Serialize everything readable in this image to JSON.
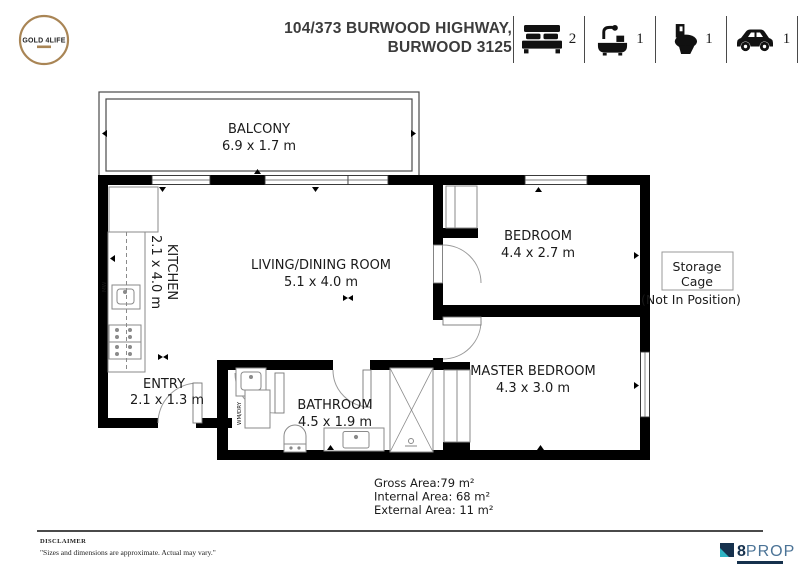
{
  "header": {
    "logo": {
      "text": "GOLD 4LIFE"
    },
    "address_line1": "104/373 BURWOOD HIGHWAY,",
    "address_line2": "BURWOOD 3125",
    "features": [
      {
        "name": "bedrooms",
        "count": "2"
      },
      {
        "name": "bathrooms",
        "count": "1"
      },
      {
        "name": "toilets",
        "count": "1"
      },
      {
        "name": "car-spaces",
        "count": "1"
      }
    ]
  },
  "floorplan": {
    "rooms": {
      "balcony": {
        "name": "BALCONY",
        "dims": "6.9 x 1.7 m"
      },
      "kitchen": {
        "name": "KITCHEN",
        "dims": "2.1 x 4.0 m"
      },
      "living": {
        "name": "LIVING/DINING ROOM",
        "dims": "5.1 x 4.0 m"
      },
      "bedroom": {
        "name": "BEDROOM",
        "dims": "4.4 x 2.7 m"
      },
      "master": {
        "name": "MASTER BEDROOM",
        "dims": "4.3 x 3.0 m"
      },
      "bathroom": {
        "name": "BATHROOM",
        "dims": "4.5 x 1.9 m"
      },
      "entry": {
        "name": "ENTRY",
        "dims": "2.1 x 1.3 m"
      }
    },
    "fixtures": {
      "laundry": "WM/DRY",
      "microwave": "MW"
    },
    "storage": {
      "line1": "Storage",
      "line2": "Cage",
      "note": "(Not In Position)"
    }
  },
  "areas": {
    "gross": "Gross Area:79 m²",
    "internal": "Internal Area: 68 m²",
    "external": "External Area: 11 m²"
  },
  "footer": {
    "disclaimer_title": "DISCLAIMER",
    "disclaimer_text": "\"Sizes and dimensions are approximate. Actual may vary.\"",
    "brand": {
      "digit": "8",
      "name": "PROP"
    }
  },
  "colors": {
    "wall": "#000000",
    "gold": "#a98555",
    "navy": "#16314d",
    "steel": "#4b7396",
    "teal": "#2fb4c4"
  }
}
